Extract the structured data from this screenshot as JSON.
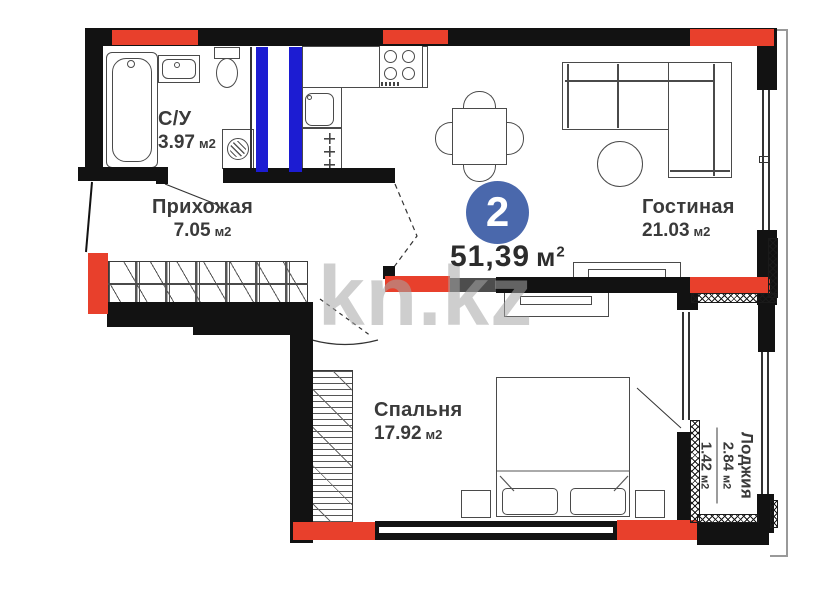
{
  "plan": {
    "badge": {
      "number": "2"
    },
    "total": {
      "value": "51,39",
      "unit": "м",
      "sup": "2"
    },
    "rooms": {
      "bathroom": {
        "name": "С/У",
        "area": "3.97",
        "unit": "м2"
      },
      "hallway": {
        "name": "Прихожая",
        "area": "7.05",
        "unit": "м2"
      },
      "living": {
        "name": "Гостиная",
        "area": "21.03",
        "unit": "м2"
      },
      "bedroom": {
        "name": "Спальня",
        "area": "17.92",
        "unit": "м2"
      },
      "loggia": {
        "name": "Лоджия",
        "area": "2.84",
        "unit": "м2",
        "area_reduced": "1.42",
        "unit_reduced": "м2"
      }
    },
    "watermark": "kn.kz",
    "colors": {
      "wall": "#121212",
      "accent_red": "#e8402c",
      "pipe_blue": "#1c1cd2",
      "badge_blue": "#4a68ac",
      "label_text": "#3a3a3a"
    }
  }
}
